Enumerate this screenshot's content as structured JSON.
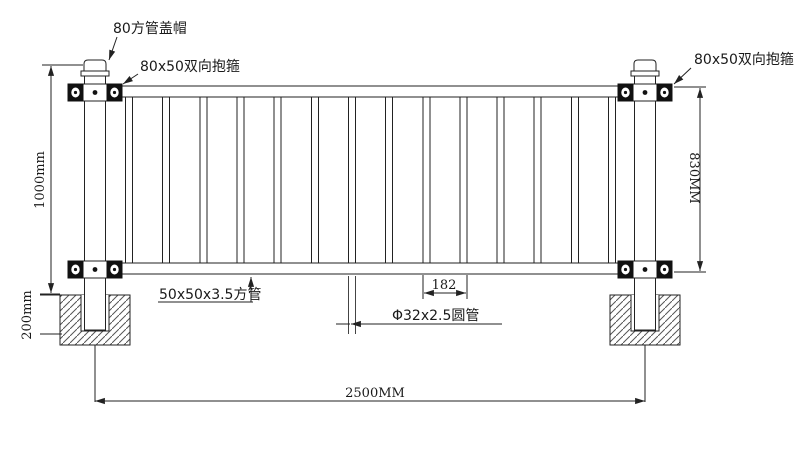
{
  "labels": {
    "post_cap": "80方管盖帽",
    "clamp_left": "80x50双向抱箍",
    "clamp_right": "80x50双向抱箍",
    "square_tube": "50x50x3.5方管",
    "round_tube": "Φ32x2.5圆管"
  },
  "dimensions": {
    "total_height": "1000mm",
    "panel_height": "830MM",
    "embed_depth": "200mm",
    "total_width": "2500MM",
    "bar_spacing": "182"
  }
}
